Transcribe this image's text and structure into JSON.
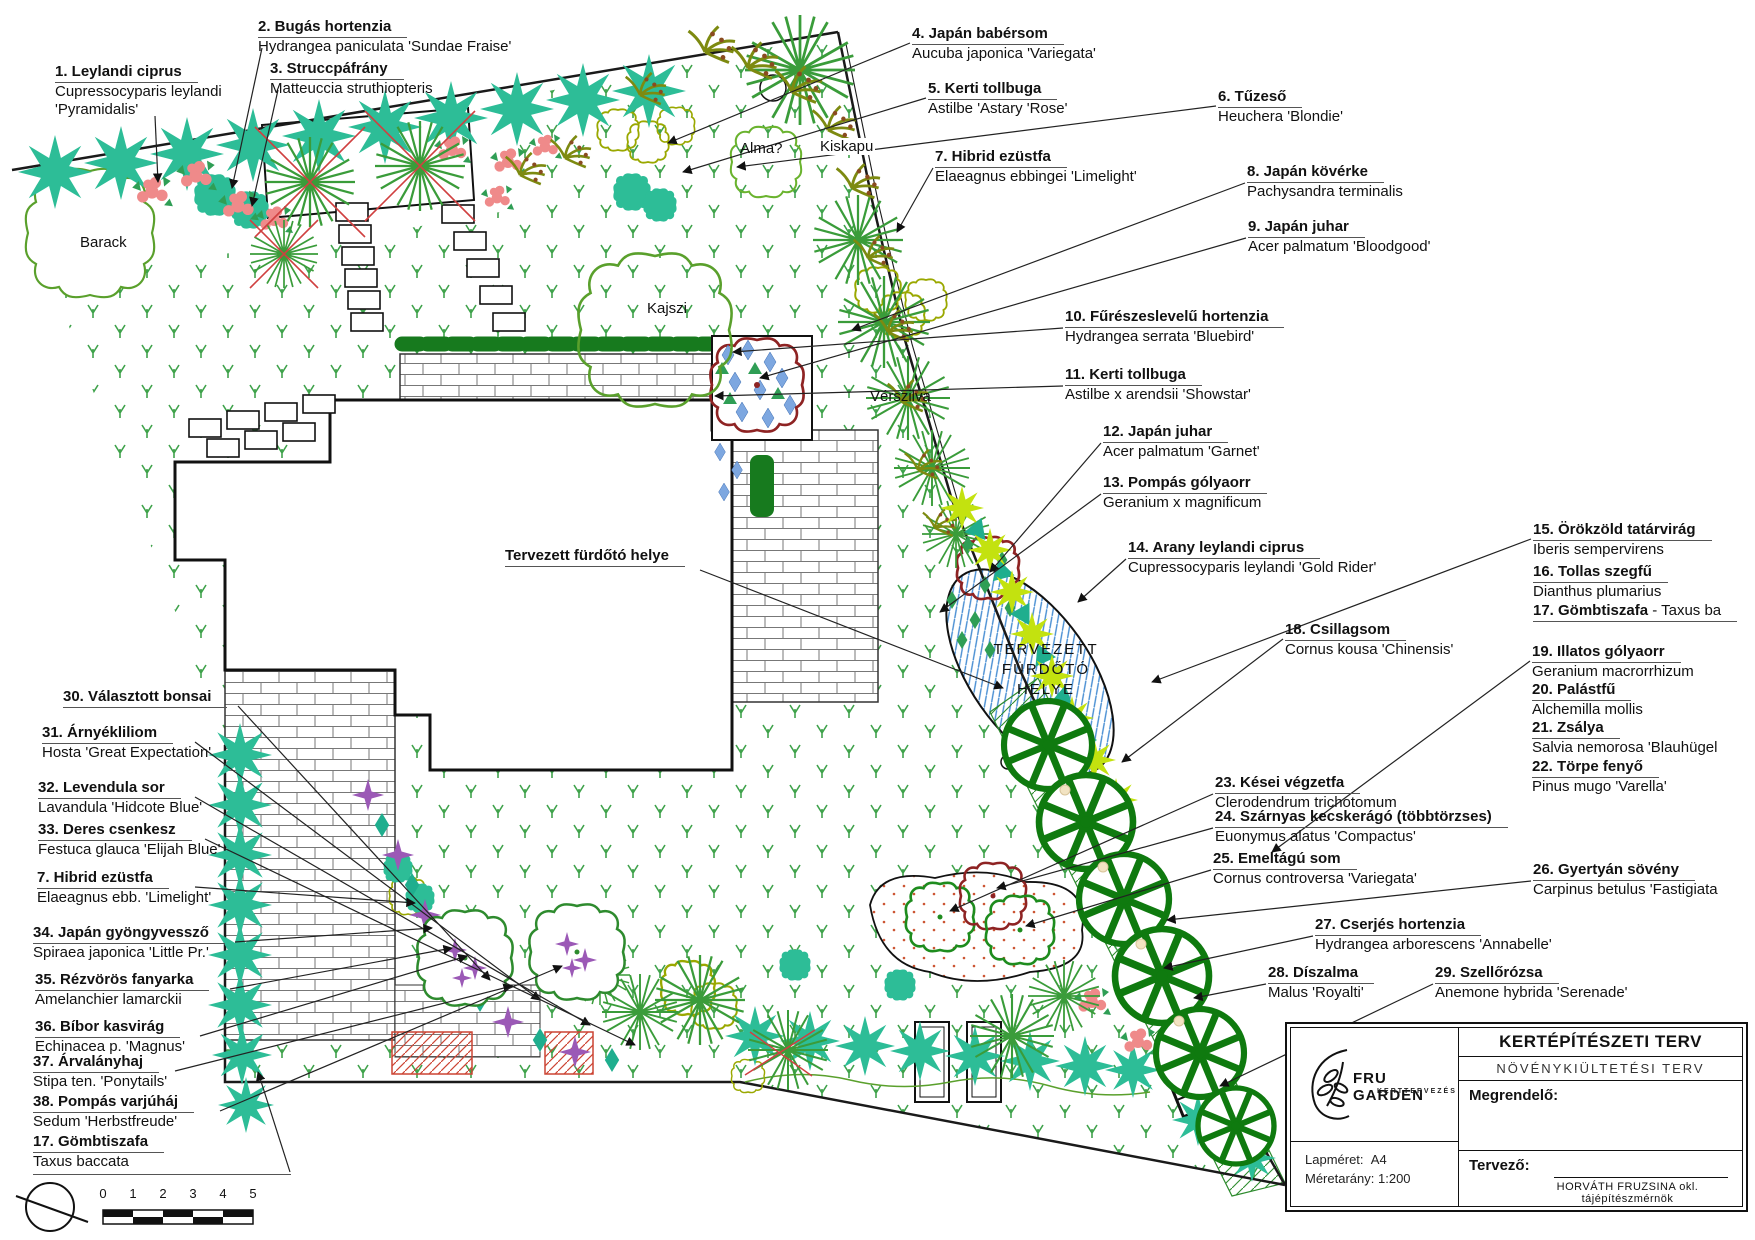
{
  "document": {
    "kind": "garden landscape plan",
    "sheet_title": "KERTÉPÍTÉSZETI TERV",
    "sheet_subtitle": "NÖVÉNYKIÜLTETÉSI TERV"
  },
  "labels": [
    {
      "t": "1. Leylandi ciprus",
      "l": [
        "Cupressocyparis leylandi",
        "'Pyramidalis'"
      ],
      "x": 55,
      "y": 63,
      "ax": 155,
      "ay": 116,
      "tx": 158,
      "ty": 182,
      "leader": true
    },
    {
      "t": "2. Bugás hortenzia",
      "l": [
        "Hydrangea paniculata 'Sundae Fraise'"
      ],
      "x": 258,
      "y": 18,
      "ax": 262,
      "ay": 48,
      "tx": 232,
      "ty": 188,
      "leader": true
    },
    {
      "t": "3. Struccpáfrány",
      "l": [
        "Matteuccia struthiopteris"
      ],
      "x": 270,
      "y": 60,
      "ax": 278,
      "ay": 90,
      "tx": 252,
      "ty": 206,
      "leader": true
    },
    {
      "t": "4. Japán babérsom",
      "l": [
        "Aucuba japonica 'Variegata'"
      ],
      "x": 912,
      "y": 25,
      "ax": 910,
      "ay": 43,
      "tx": 668,
      "ty": 143,
      "leader": true
    },
    {
      "t": "5. Kerti tollbuga",
      "l": [
        "Astilbe 'Astary 'Rose'"
      ],
      "x": 928,
      "y": 80,
      "ax": 926,
      "ay": 98,
      "tx": 683,
      "ty": 172,
      "leader": true
    },
    {
      "t": "6. Tűzeső",
      "l": [
        "Heuchera 'Blondie'"
      ],
      "x": 1218,
      "y": 88,
      "ax": 1216,
      "ay": 106,
      "tx": 737,
      "ty": 167,
      "leader": true
    },
    {
      "t": "7. Hibrid ezüstfa",
      "l": [
        "Elaeagnus ebbingei 'Limelight'"
      ],
      "x": 935,
      "y": 148,
      "ax": 933,
      "ay": 168,
      "tx": 897,
      "ty": 232,
      "leader": true
    },
    {
      "t": "8. Japán kövérke",
      "l": [
        "Pachysandra terminalis"
      ],
      "x": 1247,
      "y": 163,
      "ax": 1245,
      "ay": 183,
      "tx": 852,
      "ty": 330,
      "leader": true
    },
    {
      "t": "9. Japán juhar",
      "l": [
        "Acer palmatum 'Bloodgood'"
      ],
      "x": 1248,
      "y": 218,
      "ax": 1246,
      "ay": 238,
      "tx": 760,
      "ty": 378,
      "leader": true
    },
    {
      "t": "10. Fűrészeslevelű hortenzia",
      "l": [
        "Hydrangea serrata 'Bluebird'"
      ],
      "x": 1065,
      "y": 308,
      "ax": 1063,
      "ay": 328,
      "tx": 733,
      "ty": 352,
      "leader": true
    },
    {
      "t": "11. Kerti tollbuga",
      "l": [
        "Astilbe x arendsii 'Showstar'"
      ],
      "x": 1065,
      "y": 366,
      "ax": 1063,
      "ay": 386,
      "tx": 715,
      "ty": 396,
      "leader": true
    },
    {
      "t": "12. Japán juhar",
      "l": [
        "Acer palmatum 'Garnet'"
      ],
      "x": 1103,
      "y": 423,
      "ax": 1101,
      "ay": 443,
      "tx": 990,
      "ty": 572,
      "leader": true
    },
    {
      "t": "13. Pompás gólyaorr",
      "l": [
        "Geranium x magnificum"
      ],
      "x": 1103,
      "y": 474,
      "ax": 1101,
      "ay": 494,
      "tx": 940,
      "ty": 612,
      "leader": true
    },
    {
      "t": "14. Arany leylandi ciprus",
      "l": [
        "Cupressocyparis leylandi 'Gold Rider'"
      ],
      "x": 1128,
      "y": 539,
      "ax": 1126,
      "ay": 559,
      "tx": 1078,
      "ty": 602,
      "leader": true
    },
    {
      "t": "15. Örökzöld tatárvirág",
      "l": [
        "Iberis sempervirens"
      ],
      "x": 1533,
      "y": 521,
      "ax": 1531,
      "ay": 539,
      "tx": 1152,
      "ty": 682,
      "leader": true
    },
    {
      "t": "16. Tollas szegfű",
      "l": [
        "Dianthus plumarius"
      ],
      "x": 1533,
      "y": 563,
      "leader": false
    },
    {
      "t": "17. Gömbtiszafa",
      "tail": " - Taxus ba",
      "l": [],
      "x": 1533,
      "y": 602,
      "leader": false
    },
    {
      "t": "18. Csillagsom",
      "l": [
        "Cornus kousa 'Chinensis'"
      ],
      "x": 1285,
      "y": 621,
      "ax": 1283,
      "ay": 639,
      "tx": 1122,
      "ty": 762,
      "leader": true
    },
    {
      "t": "19. Illatos gólyaorr",
      "l": [
        "Geranium macrorrhizum"
      ],
      "x": 1532,
      "y": 643,
      "ax": 1530,
      "ay": 661,
      "tx": 1272,
      "ty": 852,
      "leader": true
    },
    {
      "t": "20. Palástfű",
      "l": [
        "Alchemilla mollis"
      ],
      "x": 1532,
      "y": 681,
      "leader": false
    },
    {
      "t": "21. Zsálya",
      "l": [
        "Salvia nemorosa 'Blauhügel"
      ],
      "x": 1532,
      "y": 719,
      "leader": false
    },
    {
      "t": "22. Törpe fenyő",
      "l": [
        "Pinus mugo 'Varella'"
      ],
      "x": 1532,
      "y": 758,
      "leader": false
    },
    {
      "t": "23. Kései végzetfa",
      "l": [
        "Clerodendrum trichotomum"
      ],
      "x": 1215,
      "y": 774,
      "ax": 1213,
      "ay": 794,
      "tx": 950,
      "ty": 911,
      "leader": true
    },
    {
      "t": "24. Szárnyas kecskerágó (többtörzses)",
      "l": [
        "Euonymus alatus 'Compactus'"
      ],
      "x": 1215,
      "y": 808,
      "ax": 1213,
      "ay": 828,
      "tx": 997,
      "ty": 888,
      "leader": true
    },
    {
      "t": "25. Emeltágú som",
      "l": [
        "Cornus controversa 'Variegata'"
      ],
      "x": 1213,
      "y": 850,
      "ax": 1211,
      "ay": 870,
      "tx": 1026,
      "ty": 926,
      "leader": true
    },
    {
      "t": "26. Gyertyán sövény",
      "l": [
        "Carpinus betulus 'Fastigiata"
      ],
      "x": 1533,
      "y": 861,
      "ax": 1531,
      "ay": 881,
      "tx": 1167,
      "ty": 920,
      "leader": true
    },
    {
      "t": "27. Cserjés hortenzia",
      "l": [
        "Hydrangea arborescens 'Annabelle'"
      ],
      "x": 1315,
      "y": 916,
      "ax": 1313,
      "ay": 936,
      "tx": 1164,
      "ty": 968,
      "leader": true
    },
    {
      "t": "28. Díszalma",
      "l": [
        "Malus 'Royalti'"
      ],
      "x": 1268,
      "y": 964,
      "ax": 1266,
      "ay": 984,
      "tx": 1194,
      "ty": 998,
      "leader": true
    },
    {
      "t": "29. Szellőrózsa",
      "l": [
        "Anemone hybrida 'Serenade'"
      ],
      "x": 1435,
      "y": 964,
      "ax": 1433,
      "ay": 984,
      "tx": 1220,
      "ty": 1086,
      "leader": true
    },
    {
      "t": "30. Választott bonsai",
      "l": [],
      "x": 63,
      "y": 688,
      "ax": 238,
      "ay": 706,
      "tx": 490,
      "ty": 980,
      "leader": true
    },
    {
      "t": "31. Árnyékliliom",
      "l": [
        "Hosta 'Great Expectation'"
      ],
      "x": 42,
      "y": 724,
      "ax": 195,
      "ay": 742,
      "tx": 540,
      "ty": 1000,
      "leader": true
    },
    {
      "t": "32. Levendula sor",
      "l": [
        "Lavandula 'Hidcote Blue'"
      ],
      "x": 38,
      "y": 779,
      "ax": 195,
      "ay": 797,
      "tx": 590,
      "ty": 1025,
      "leader": true
    },
    {
      "t": "33. Deres csenkesz",
      "l": [
        "Festuca glauca 'Elijah Blue'"
      ],
      "x": 38,
      "y": 821,
      "ax": 205,
      "ay": 839,
      "tx": 635,
      "ty": 1045,
      "leader": true
    },
    {
      "t": "7. Hibrid ezüstfa",
      "l": [
        "Elaeagnus ebb. 'Limelight'"
      ],
      "x": 37,
      "y": 869,
      "ax": 195,
      "ay": 887,
      "tx": 415,
      "ty": 903,
      "leader": true
    },
    {
      "t": "34. Japán gyöngyvessző",
      "l": [
        "Spiraea japonica 'Little Pr.'"
      ],
      "x": 33,
      "y": 924,
      "ax": 235,
      "ay": 942,
      "tx": 432,
      "ty": 928,
      "leader": true
    },
    {
      "t": "35. Rézvörös fanyarka",
      "l": [
        "Amelanchier lamarckii"
      ],
      "x": 35,
      "y": 971,
      "ax": 230,
      "ay": 989,
      "tx": 452,
      "ty": 948,
      "leader": true
    },
    {
      "t": "36. Bíbor kasvirág",
      "l": [
        "Echinacea p. 'Magnus'"
      ],
      "x": 35,
      "y": 1018,
      "ax": 200,
      "ay": 1036,
      "tx": 467,
      "ty": 956,
      "leader": true
    },
    {
      "t": "37. Árvalányhaj",
      "l": [
        "Stipa ten. 'Ponytails'"
      ],
      "x": 33,
      "y": 1053,
      "ax": 175,
      "ay": 1071,
      "tx": 512,
      "ty": 986,
      "leader": true
    },
    {
      "t": "38. Pompás varjúháj",
      "l": [
        "Sedum 'Herbstfreude'"
      ],
      "x": 33,
      "y": 1093,
      "ax": 220,
      "ay": 1111,
      "tx": 562,
      "ty": 966,
      "leader": true
    },
    {
      "t": "17. Gömbtiszafa",
      "l": [
        "Taxus baccata"
      ],
      "x": 33,
      "y": 1133,
      "ax": 290,
      "ay": 1172,
      "tx": 258,
      "ty": 1072,
      "leader": true,
      "fullu": true
    },
    {
      "t": "Tervezett fürdőtó helye",
      "l": [],
      "x": 505,
      "y": 547,
      "ax": 700,
      "ay": 570,
      "tx": 1003,
      "ty": 688,
      "leader": true
    }
  ],
  "annotations": [
    {
      "text": "Barack",
      "x": 80,
      "y": 234,
      "style": "plain"
    },
    {
      "text": "Alma?",
      "x": 740,
      "y": 140,
      "style": "plain"
    },
    {
      "text": "Kiskapu",
      "x": 818,
      "y": 138,
      "style": "chip"
    },
    {
      "text": "Kajszi",
      "x": 647,
      "y": 300,
      "style": "plain"
    },
    {
      "text": "Vérszilva",
      "x": 870,
      "y": 388,
      "style": "plain"
    }
  ],
  "pond_text": {
    "lines": [
      "TERVEZETT",
      "FÜRDŐTÓ",
      "HELYE"
    ],
    "x": 976,
    "y": 640,
    "w": 140
  },
  "title_block": {
    "title": "KERTÉPÍTÉSZETI TERV",
    "subtitle": "NÖVÉNYKIÜLTETÉSI TERV",
    "client_label": "Megrendelő:",
    "designer_label": "Tervező:",
    "designer_name": "HORVÁTH FRUZSINA okl. tájépítészmérnök",
    "sheet_label": "Lapméret:",
    "sheet_value": "A4",
    "scale_label": "Méretarány:",
    "scale_value": "1:200",
    "logo_line1": "FRU GARDEN",
    "logo_line2": "KERTTERVEZÉS"
  },
  "scale_bar": {
    "ticks": [
      "0",
      "1",
      "2",
      "3",
      "4",
      "5"
    ]
  },
  "colors": {
    "conifer_teal": "#2dbd97",
    "lime_star": "#c3e20f",
    "accent_teal": "#1fae8e",
    "grass_green": "#3fa24b",
    "dark_hedge": "#177a1e",
    "wheel_green": "#0f7a0f",
    "maple_red": "#8e2323",
    "pond_blue": "#4a8fd3",
    "pink_flower": "#ef8a8a",
    "purple_flower": "#9b59b6",
    "olive": "#9aa800"
  }
}
